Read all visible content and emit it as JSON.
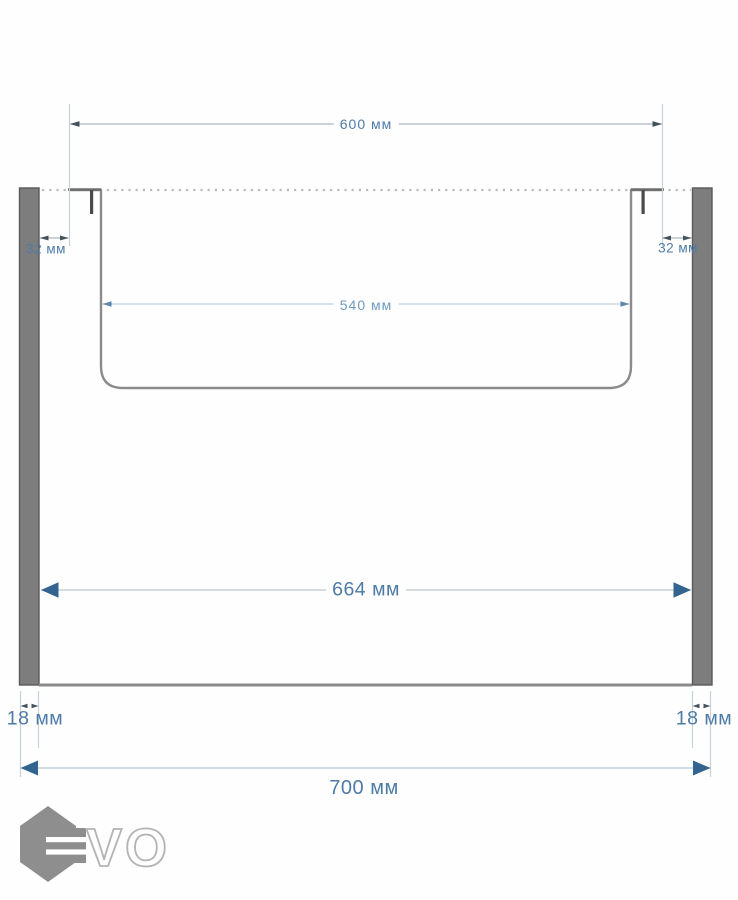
{
  "diagram": {
    "type": "technical-dimension-drawing",
    "subject": "cabinet cross-section with inset sink between two side panels",
    "unit": "мм",
    "dimensions": {
      "sink_outer_width": {
        "label": "600 мм",
        "value": 600
      },
      "sink_bowl_width": {
        "label": "540 мм",
        "value": 540
      },
      "cabinet_inner_width": {
        "label": "664 мм",
        "value": 664
      },
      "cabinet_outer_width": {
        "label": "700 мм",
        "value": 700
      },
      "rim_offset_left": {
        "label": "32 мм",
        "value": 32
      },
      "rim_offset_right": {
        "label": "32 мм",
        "value": 32
      },
      "panel_thickness_left": {
        "label": "18 мм",
        "value": 18
      },
      "panel_thickness_right": {
        "label": "18 мм",
        "value": 18
      }
    }
  },
  "logo": {
    "brand": "EVO",
    "outlined_letters": "VO"
  },
  "colors": {
    "dimension_text": "#4e7ba6",
    "dimension_text_light": "#6f9cbd",
    "thin_line": "#aab8c2",
    "extension_line": "#c9d2d8",
    "small_arrow": "#44525c",
    "solid_arrow_blue": "#33638f",
    "panel_gray": "#7d7d7d",
    "sink_outline_gray": "#8b8b8b",
    "dotted_line_gray": "#bcbcbc",
    "logo_gray": "#8e8e8e"
  }
}
